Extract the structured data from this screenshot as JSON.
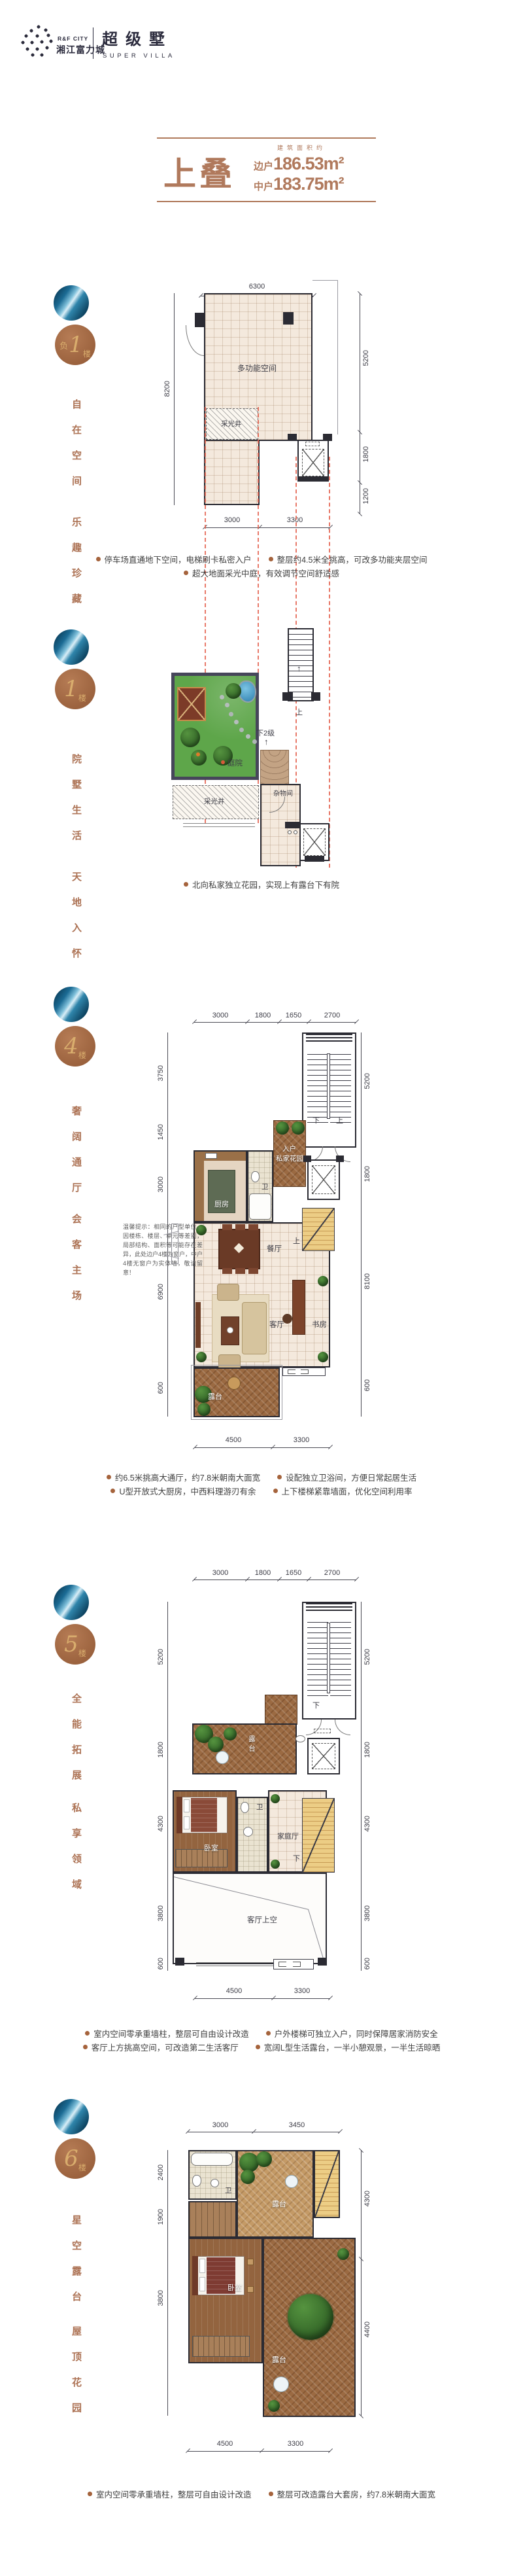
{
  "page": {
    "background": "#ffffff",
    "accent_bronze": "#b0795c",
    "badge_brown": "#a9714c",
    "badge_gold": "#d9ad6d",
    "badge_blue": "#1b6b94",
    "red_dash": "#e4614e"
  },
  "header": {
    "logo_sub_en": "R&F CITY",
    "logo_cn": "湘江富力城",
    "product_cn": "超级墅",
    "product_en": "SUPER VILLA"
  },
  "title": {
    "name": "上叠",
    "area_label": "建筑面积约",
    "side_label": "边户",
    "side_value": "186.53m²",
    "mid_label": "中户",
    "mid_value": "183.75m²"
  },
  "icons": {
    "arrow_up": "↑"
  },
  "sections": [
    {
      "floor_prefix": "负",
      "floor_num": "1",
      "floor_suffix": "楼",
      "phrase_a": "自在空间",
      "phrase_b": "乐趣珍藏",
      "labels": {
        "multi": "多功能空间",
        "lightwell": "采光井"
      },
      "dims": {
        "top": [
          "6300"
        ],
        "left": [
          "8200"
        ],
        "right": [
          "5200",
          "1800",
          "1200"
        ],
        "bottom": [
          "3000",
          "3300"
        ]
      },
      "bullets": [
        "停车场直通地下空间，电梯刷卡私密入户",
        "整层约4.5米全挑高，可改多功能夹层空间",
        "超大地面采光中庭，有效调节空间舒适感"
      ]
    },
    {
      "floor_prefix": "",
      "floor_num": "1",
      "floor_suffix": "楼",
      "phrase_a": "院墅生活",
      "phrase_b": "天地入怀",
      "labels": {
        "court": "庭院",
        "lightwell": "采光井",
        "storage": "杂物间",
        "up": "上",
        "down2": "下2级"
      },
      "bullets": [
        "北向私家独立花园，实现上有露台下有院"
      ]
    },
    {
      "floor_prefix": "",
      "floor_num": "4",
      "floor_suffix": "楼",
      "phrase_a": "奢阔通厅",
      "phrase_b": "会客主场",
      "labels": {
        "foyer1": "入户",
        "foyer2": "私家花园",
        "kitchen": "厨房",
        "bath": "卫",
        "dining": "餐厅",
        "living": "客厅",
        "study": "书房",
        "terrace": "露台",
        "down": "下",
        "up": "上",
        "stair_up": "上"
      },
      "dims": {
        "top": [
          "3000",
          "1800",
          "1650",
          "2700"
        ],
        "left": [
          "3750",
          "1450",
          "3000",
          "6900",
          "600"
        ],
        "right": [
          "5200",
          "1800",
          "8100",
          "600"
        ],
        "bottom": [
          "4500",
          "3300"
        ]
      },
      "note": "温馨提示：相同的户型单位，因楼栋、楼层、单元等差别，局部结构、面积等可能存在差异，此处边户4楼为窗户，中户4楼无窗户为实体墙，敬请留意！",
      "bullets": [
        "约6.5米挑高大通厅，约7.8米朝南大面宽",
        "设配独立卫浴间，方便日常起居生活",
        "U型开放式大厨房，中西料理游刃有余",
        "上下楼梯紧靠墙面，优化空间利用率"
      ]
    },
    {
      "floor_prefix": "",
      "floor_num": "5",
      "floor_suffix": "楼",
      "phrase_a": "全能拓展",
      "phrase_b": "私享领域",
      "labels": {
        "terrace": "露台",
        "bedroom": "卧室",
        "bath": "卫",
        "family": "家庭厅",
        "void": "客厅上空",
        "down_a": "下",
        "down_b": "下"
      },
      "dims": {
        "top": [
          "3000",
          "1800",
          "1650",
          "2700"
        ],
        "left": [
          "5200",
          "1800",
          "4300",
          "3800",
          "600"
        ],
        "right": [
          "5200",
          "1800",
          "4300",
          "3800",
          "600"
        ],
        "bottom": [
          "4500",
          "3300"
        ]
      },
      "bullets": [
        "室内空间零承重墙柱，整层可自由设计改造",
        "户外楼梯可独立入户，同时保障居家消防安全",
        "客厅上方挑高空间，可改造第二生活客厅",
        "宽阔L型生活露台，一半小憩观景，一半生活晾晒"
      ]
    },
    {
      "floor_prefix": "",
      "floor_num": "6",
      "floor_suffix": "楼",
      "phrase_a": "星空露台",
      "phrase_b": "屋顶花园",
      "labels": {
        "bath": "卫",
        "bedroom": "卧室",
        "terrace_top": "露台",
        "terrace": "露台"
      },
      "dims": {
        "top": [
          "3000",
          "3450"
        ],
        "left": [
          "2400",
          "1900",
          "3800"
        ],
        "right": [
          "4300",
          "4400"
        ],
        "bottom": [
          "4500",
          "3300"
        ]
      },
      "bullets": [
        "室内空间零承重墙柱，整层可自由设计改造",
        "整层可改造露台大套房，约7.8米朝南大面宽"
      ]
    }
  ]
}
